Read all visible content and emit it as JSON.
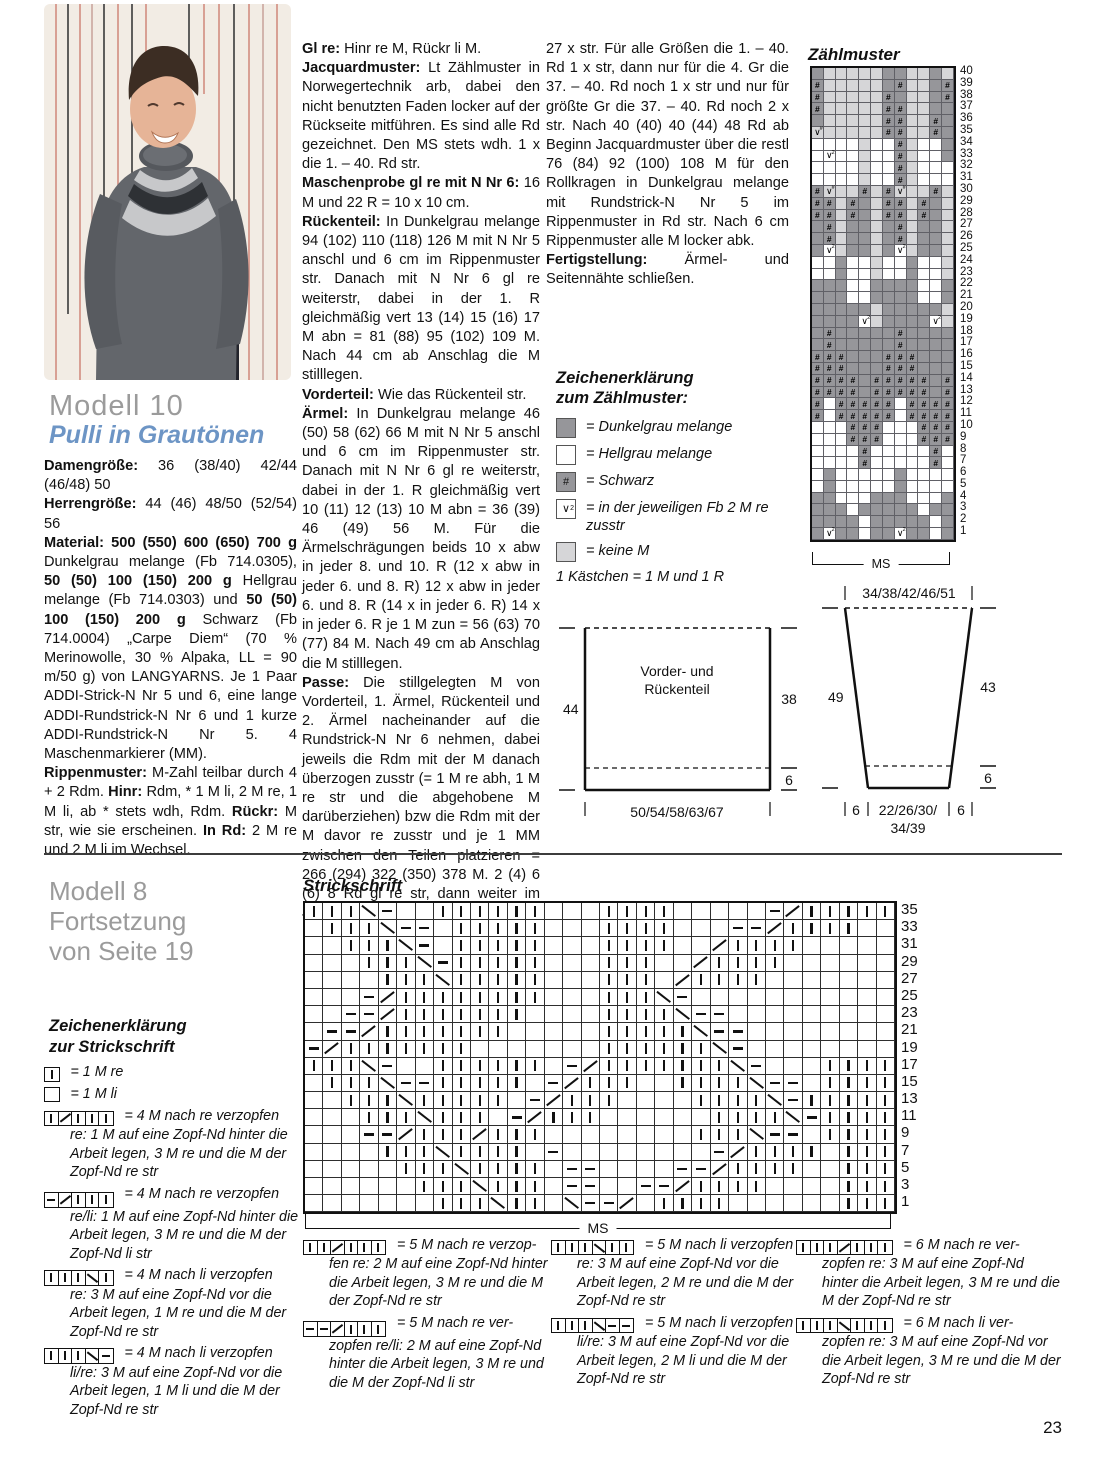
{
  "page_number": "23",
  "colors": {
    "chart_dark": "#96969a",
    "chart_light": "#ffffff",
    "chart_none": "#d6d6d8",
    "subtitle_blue": "#6d95c5",
    "heading_gray": "#9b9b9b"
  },
  "model10": {
    "title": "Modell 10",
    "subtitle": "Pulli in Grautönen",
    "col1": [
      [
        {
          "b": "Damengröße:"
        },
        {
          "t": " 36 (38/40) 42/44 (46/48) 50"
        }
      ],
      [
        {
          "b": "Herrengröße:"
        },
        {
          "t": " 44 (46) 48/50 (52/54) 56"
        }
      ],
      [
        {
          "b": "Material: 500 (550) 600 (650) 700 g"
        },
        {
          "t": " Dunkelgrau melange (Fb 714.0305), "
        },
        {
          "b": "50 (50) 100 (150) 200 g"
        },
        {
          "t": " Hellgrau melange (Fb 714.0303) und "
        },
        {
          "b": "50 (50) 100 (150) 200 g"
        },
        {
          "t": " Schwarz (Fb 714.0004) „Carpe Diem“ (70 % Merinowolle, 30 % Alpaka, LL = 90 m/50 g) von LANGYARNS. Je 1 Paar ADDI-Strick-N Nr 5 und 6, eine lange ADDI-Rundstrick-N Nr 6 und 1 kurze ADDI-Rundstrick-N Nr 5. 4 Maschenmarkierer (MM)."
        }
      ],
      [
        {
          "b": "Rippenmuster:"
        },
        {
          "t": " M-Zahl teilbar durch 4 + 2 Rdm. "
        },
        {
          "b": "Hinr:"
        },
        {
          "t": " Rdm, * 1 M li, 2 M re, 1 M li, ab * stets wdh, Rdm. "
        },
        {
          "b": "Rückr:"
        },
        {
          "t": " M str, wie sie erscheinen. "
        },
        {
          "b": "In Rd:"
        },
        {
          "t": " 2 M re und 2 M li im Wechsel."
        }
      ]
    ],
    "col2": [
      [
        {
          "b": "Gl re:"
        },
        {
          "t": " Hinr re M, Rückr li M."
        }
      ],
      [
        {
          "b": "Jacquardmuster:"
        },
        {
          "t": " Lt Zählmuster in Norwegertechnik arb, dabei den nicht benutzten Faden locker auf der Rückseite mitführen. Es sind alle Rd gezeichnet. Den MS stets wdh. 1 x die 1. – 40. Rd str."
        }
      ],
      [
        {
          "b": "Maschenprobe gl re mit N Nr 6:"
        },
        {
          "t": " 16 M und 22 R = 10 x 10 cm."
        }
      ],
      [
        {
          "b": "Rückenteil:"
        },
        {
          "t": " In Dunkelgrau melange 94 (102) 110 (118) 126 M mit N Nr 5 anschl und 6 cm im Rippenmuster str. Danach mit N Nr 6 gl re weiterstr, dabei in der 1. R gleichmäßig vert 13 (14) 15 (16) 17 M abn = 81 (88) 95 (102) 109 M. Nach 44 cm ab Anschlag die M stilllegen."
        }
      ],
      [
        {
          "b": "Vorderteil:"
        },
        {
          "t": " Wie das Rückenteil str."
        }
      ],
      [
        {
          "b": "Ärmel:"
        },
        {
          "t": " In Dunkelgrau melange 46 (50) 58 (62) 66 M mit N Nr 5 anschl und 6 cm im Rippenmuster str. Danach mit N Nr 6 gl re weiterstr, dabei in der 1. R gleichmäßig vert 10 (11) 12 (13) 10 M abn = 36 (39) 46 (49) 56 M. Für die Ärmelschrägungen beids 10 x abw in jeder 8. und 10. R (12 x abw in jeder 6. und 8. R) 12 x abw in jeder 6. und 8. R (14 x in jeder 6. R) 14 x in jeder 6. R je 1 M zun = 56 (63) 70 (77) 84 M. Nach 49 cm ab Anschlag die M stilllegen."
        }
      ],
      [
        {
          "b": "Passe:"
        },
        {
          "t": " Die stillgelegten M von Vorderteil, 1. Ärmel, Rückenteil und 2. Ärmel nacheinander auf die Rundstrick-N Nr 6 nehmen, dabei jeweils die Rdm mit der M danach überzogen zusstr (= 1 M re abh, 1 M re str und die abgehobene M darüberziehen) bzw die Rdm mit der M davor re zusstr und je 1 MM zwischen den Teilen platzieren = 266 (294) 322 (350) 378 M. 2 (4) 6 (6) 8 Rd gl re str, dann weiter im Jacquardmuster arb, dabei den MS 19 (21) 23 (25)"
        }
      ]
    ],
    "col3": [
      [
        {
          "t": "27 x str. Für alle Größen die 1. – 40. Rd 1 x str, dann nur für die 4. Gr die 37. – 40. Rd noch 1 x str und nur für größte Gr die 37. – 40. Rd noch 2 x str. Nach 40 (40) 40 (44) 48 Rd ab Beginn Jacquardmuster über die restl 76 (84) 92 (100) 108 M für den Rollkragen in Dunkelgrau melange mit Rundstrick-N Nr 5 im Rippenmuster in Rd str. Nach 6 cm Rippenmuster alle M locker abk."
        }
      ],
      [
        {
          "b": "Fertigstellung:"
        },
        {
          "t": " Ärmel- und Seitennähte schließen."
        }
      ]
    ]
  },
  "zaehlmuster": {
    "title": "Zählmuster",
    "ms_label": "MS",
    "row_numbers": [
      40,
      39,
      38,
      37,
      36,
      35,
      34,
      33,
      32,
      31,
      30,
      29,
      28,
      27,
      26,
      25,
      24,
      23,
      22,
      21,
      20,
      19,
      18,
      17,
      16,
      15,
      14,
      13,
      12,
      11,
      10,
      9,
      8,
      7,
      6,
      5,
      4,
      3,
      2,
      1
    ],
    "rows": [
      "DGGGGGDDGGDG",
      "HGGGGGDHGGDH",
      "HGGGGGHDGGDH",
      "HGGGGGHHGGDD",
      "DGGGGGHHGGHD",
      "XGGGGGHHGGHD",
      "WWWWGWWHGWWD",
      "WVWWGWWHGWWD",
      "WWWWGWWHGWWW",
      "WWWWGWWHGWWW",
      "HXGGHGHXGGHG",
      "HHGHDGHHGHDG",
      "HHGHDGHHGHDG",
      "DHGDDGDHGDDG",
      "DHGDDGDHGDDG",
      "DVGDDGDVGDDG",
      "WWDWWGWWDWWG",
      "WWDWWGWWDWWG",
      "DDDWWDDDDWWD",
      "DDDWWDDDDWWD",
      "DDDDDGDDDDDG",
      "DDDDVGDDDDVG",
      "DHDDDDDHDDDD",
      "DHDDDDDHDDDD",
      "HHHDDDHHHDDD",
      "HHHDDDHHHDDD",
      "HHHHDHHHHHDH",
      "HHHHDHHHHHDH",
      "HWHHHHHWHHHH",
      "HWHHHHHWHHHH",
      "WWWHHHWWWHHH",
      "WWWHHHWWWHHH",
      "WWWWHWWWWWHW",
      "WWWWHWWWWWHW",
      "WDWWWWWDWWWW",
      "WDWWWWWDWWWW",
      "DDWWWDDDWWWD",
      "DDDWDDDDDWDD",
      "DDDDWDDDDDWD",
      "DVDDWDDVDDWD"
    ],
    "legend_title_1": "Zeichenerklärung",
    "legend_title_2": "zum Zählmuster:",
    "legend": [
      {
        "sym": "D",
        "label": "= Dunkelgrau melange"
      },
      {
        "sym": "W",
        "label": "= Hellgrau melange"
      },
      {
        "sym": "H",
        "label": "= Schwarz"
      },
      {
        "sym": "V",
        "label": "= in der jeweiligen Fb 2 M re zusstr"
      },
      {
        "sym": "G",
        "label": "= keine M"
      }
    ],
    "legend_footer": "1 Kästchen = 1 M und 1 R"
  },
  "schematics": {
    "body": {
      "label_1": "Vorder- und",
      "label_2": "Rückenteil",
      "left": "44",
      "right_top": "38",
      "right_bottom": "6",
      "bottom": "50/54/58/63/67"
    },
    "sleeve": {
      "label": "Ärmel",
      "top": "34/38/42/46/51",
      "left": "49",
      "right_top": "43",
      "right_bottom": "6",
      "bottom_left": "6",
      "bottom_center_1": "22/26/30/",
      "bottom_center_2": "34/39",
      "bottom_right": "6"
    }
  },
  "model8": {
    "title_1": "Modell 8",
    "title_2": "Fortsetzung",
    "title_3": "von Seite 19",
    "strickschrift_title": "Strickschrift",
    "ms_label": "MS",
    "row_numbers": [
      35,
      33,
      31,
      29,
      27,
      25,
      23,
      21,
      19,
      17,
      15,
      13,
      11,
      9,
      7,
      5,
      3,
      1
    ],
    "rows": [
      "KKKBP..KKKKKK...KKKK.....PFKKKKK",
      ".KKKBPP.KKKKK...KKKK...PPFKKKK..",
      "..KKKBP.KKKKK...KKKK..FKKKK.....",
      "...KKKBPKKKKK...KKK..FKKKK......",
      "....KKKBKKKKK...KKK.FKKKK.......",
      "...PFKKKKKKKK...KKKBP...........",
      "..PPFKKKKKKK....KKKKBPP.........",
      ".PPFKKKKKKK.....KKKKKBPP........",
      "PFKKKKKKK.......KKKKKKBP........",
      "KKKBP..KKKKKK.PFKKKKKKKBP...KKKK",
      ".KKKBPPKKKKK.PFKKK..KKKKBPP.KKKK",
      "..KKKBKKKKK.PFKKK....KKKKBPKKKKK",
      "...KKKBKKK.PFKKK......KKKKBPKKKK",
      "...PPFKKKFKKK........KKKBPP.KKKK",
      "....KKKBKKKK.P........PFKKKK.KKK",
      ".....KKKBKKKK.PP....PPFKKKK..KKK",
      "......KKKBKKK.PP..PPFKKKK....KKK",
      ".......KKKBKK.BPPF.KKKK......KKK"
    ],
    "legend_title_1": "Zeichenerklärung",
    "legend_title_2": "zur Strickschrift",
    "legend_left": [
      {
        "sym": "K",
        "head": "= 1 M re",
        "desc": ""
      },
      {
        "sym": "E",
        "head": "= 1 M li",
        "desc": ""
      },
      {
        "sym": "KFKKK",
        "head": "= 4 M nach re verzopfen",
        "desc": "re: 1 M auf eine Zopf-Nd hinter die Arbeit legen, 3 M re und die M der Zopf-Nd re str"
      },
      {
        "sym": "PFKKK",
        "head": "= 4 M nach re verzopfen",
        "desc": "re/li: 1 M auf eine Zopf-Nd hinter die Arbeit legen, 3 M re und die M der Zopf-Nd li str"
      },
      {
        "sym": "KKKBK",
        "head": "= 4 M nach li verzopfen",
        "desc": "re: 3 M auf eine Zopf-Nd vor die Arbeit legen, 1 M re und die M der Zopf-Nd re str"
      },
      {
        "sym": "KKKBP",
        "head": "= 4 M nach li verzopfen",
        "desc": "li/re: 3 M auf eine Zopf-Nd vor die Arbeit legen, 1 M li und die M der Zopf-Nd re str"
      }
    ],
    "legend_col1": [
      {
        "sym": "KKFKKK",
        "head": "= 5 M nach re verzop-",
        "desc": "fen re: 2 M auf eine Zopf-Nd hinter die Arbeit legen, 3 M re und die M der Zopf-Nd re str"
      },
      {
        "sym": "PPFKKK",
        "head": "= 5 M nach re ver-",
        "desc": "zopfen re/li: 2 M auf eine Zopf-Nd hinter die Arbeit legen, 3 M re und die M der Zopf-Nd li str"
      }
    ],
    "legend_col2": [
      {
        "sym": "KKKBKK",
        "head": "= 5 M nach li verzopfen",
        "desc": "re: 3 M auf eine Zopf-Nd vor die Arbeit legen, 2 M re und die M der Zopf-Nd re str"
      },
      {
        "sym": "KKKBPP",
        "head": "= 5 M nach li verzopfen",
        "desc": "li/re: 3 M auf eine Zopf-Nd vor die Arbeit legen, 2 M li und die M der Zopf-Nd re str"
      }
    ],
    "legend_col3": [
      {
        "sym": "KKKFKKK",
        "head": "= 6 M nach re ver-",
        "desc": "zopfen re: 3 M auf eine Zopf-Nd hinter die Arbeit legen, 3 M re und die M der Zopf-Nd re str"
      },
      {
        "sym": "KKKBKKK",
        "head": "= 6 M nach li ver-",
        "desc": "zopfen re: 3 M auf eine Zopf-Nd vor die Arbeit legen, 3 M re und die M der Zopf-Nd re str"
      }
    ]
  }
}
